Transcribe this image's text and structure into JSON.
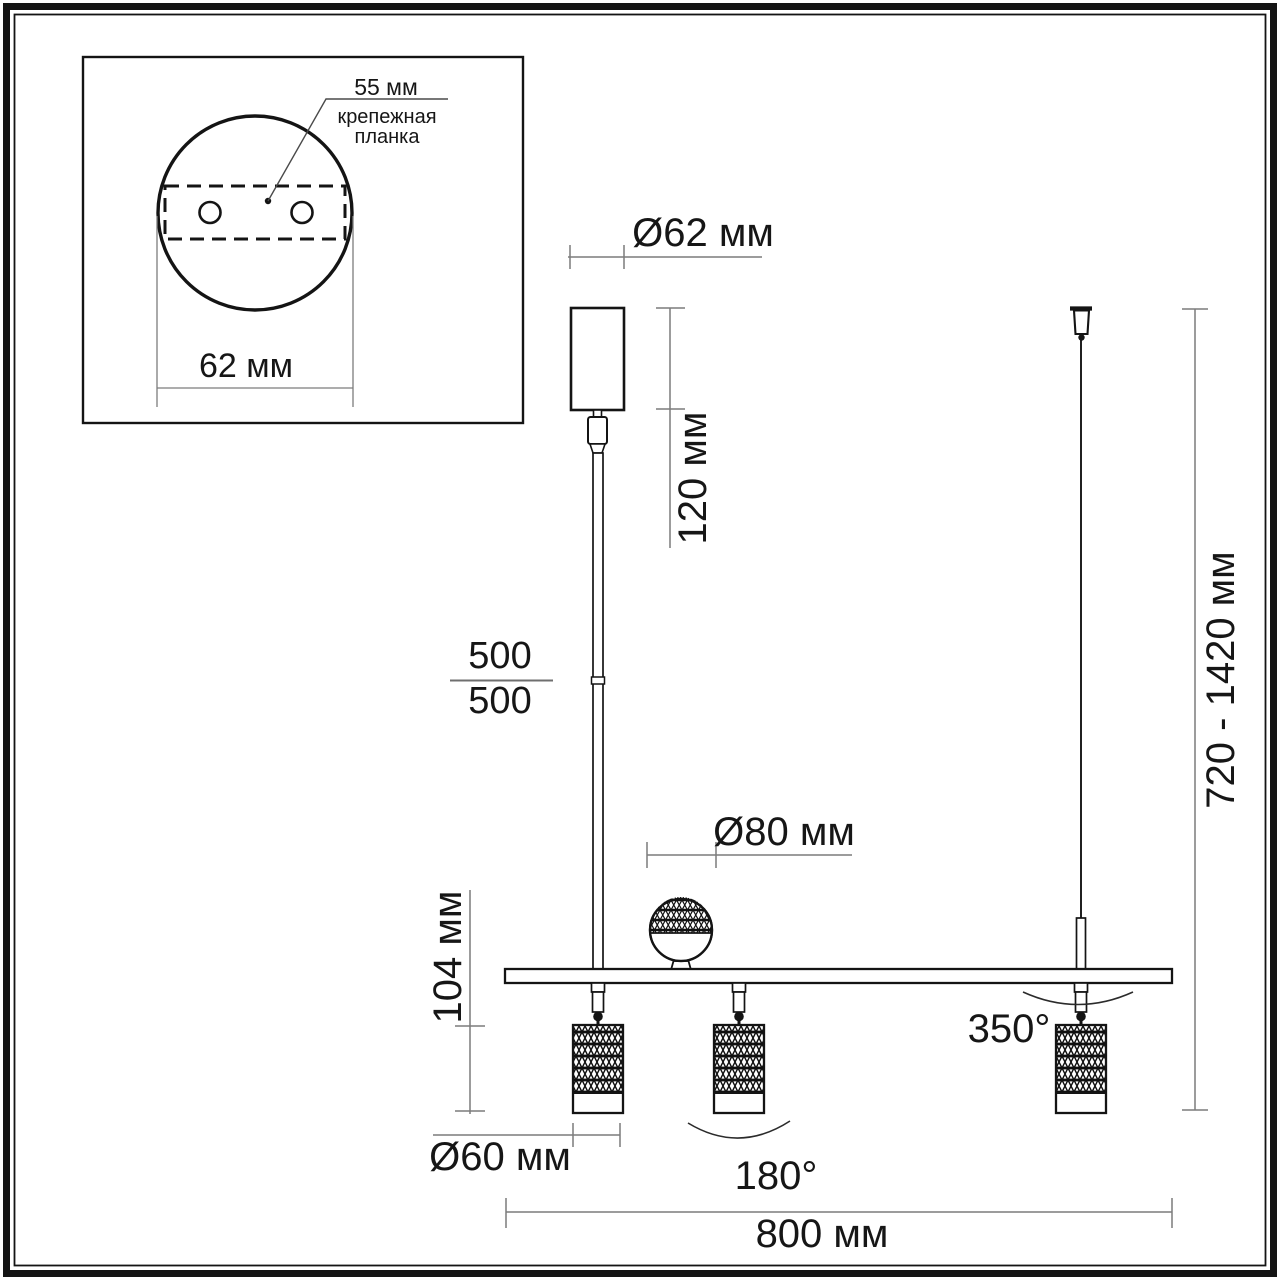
{
  "drawing": {
    "title_semantic": "pendant track light dimension drawing",
    "inset": {
      "spacing_label": "55 мм",
      "bracket_label_line1": "крепежная",
      "bracket_label_line2": "планка",
      "plate_diameter_label": "62 мм"
    },
    "dims": {
      "canopy_diameter": "Ø62 мм",
      "canopy_height": "120 мм",
      "rod_segment_upper": "500",
      "rod_segment_lower": "500",
      "sphere_diameter": "Ø80 мм",
      "head_height": "104 мм",
      "head_diameter": "Ø60 мм",
      "bar_length": "800 мм",
      "overall_height": "720 - 1420 мм",
      "swivel_angle": "350°",
      "tilt_angle": "180°"
    },
    "colors": {
      "background": "#ffffff",
      "drawing_line": "#141414",
      "dimension_line": "#7c7c7c",
      "text": "#161616"
    }
  }
}
